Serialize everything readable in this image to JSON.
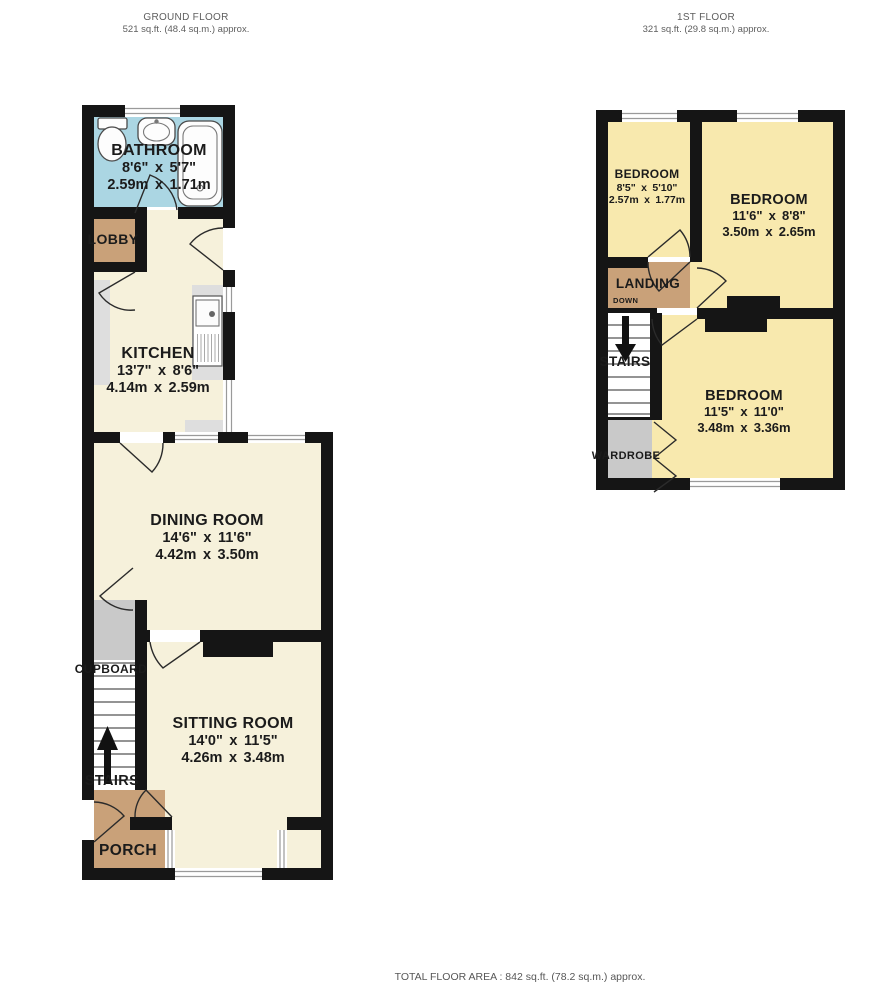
{
  "header": {
    "ground": {
      "title": "GROUND FLOOR",
      "area": "521 sq.ft. (48.4 sq.m.) approx."
    },
    "first": {
      "title": "1ST FLOOR",
      "area": "321 sq.ft. (29.8 sq.m.) approx."
    }
  },
  "footer": {
    "total": "TOTAL FLOOR AREA : 842 sq.ft. (78.2 sq.m.) approx."
  },
  "colors": {
    "wall": "#151515",
    "ground_rooms": "#f6f1db",
    "bedrooms": "#f8e9ae",
    "bathroom": "#abd6e3",
    "halls": "#c9a179",
    "storage": "#c9c9c9",
    "counters": "#dedede"
  },
  "ground_floor": {
    "rooms": {
      "bathroom": {
        "name": "BATHROOM",
        "dims_ft": "8'6\" x 5'7\"",
        "dims_m": "2.59m x 1.71m"
      },
      "lobby": {
        "name": "LOBBY"
      },
      "kitchen": {
        "name": "KITCHEN",
        "dims_ft": "13'7\" x 8'6\"",
        "dims_m": "4.14m x 2.59m"
      },
      "dining_room": {
        "name": "DINING ROOM",
        "dims_ft": "14'6\" x 11'6\"",
        "dims_m": "4.42m x 3.50m"
      },
      "sitting_room": {
        "name": "SITTING ROOM",
        "dims_ft": "14'0\" x 11'5\"",
        "dims_m": "4.26m x 3.48m"
      },
      "cupboard": {
        "name": "CUPBOARD"
      },
      "stairs": {
        "name": "STAIRS"
      },
      "porch": {
        "name": "PORCH"
      }
    }
  },
  "first_floor": {
    "rooms": {
      "bedroom_small": {
        "name": "BEDROOM",
        "dims_ft": "8'5\" x 5'10\"",
        "dims_m": "2.57m x 1.77m"
      },
      "bedroom_front": {
        "name": "BEDROOM",
        "dims_ft": "11'6\" x 8'8\"",
        "dims_m": "3.50m x 2.65m"
      },
      "bedroom_back": {
        "name": "BEDROOM",
        "dims_ft": "11'5\" x 11'0\"",
        "dims_m": "3.48m x 3.36m"
      },
      "landing": {
        "name": "LANDING",
        "direction": "DOWN"
      },
      "stairs": {
        "name": "STAIRS"
      },
      "wardrobe": {
        "name": "WARDROBE"
      }
    }
  }
}
